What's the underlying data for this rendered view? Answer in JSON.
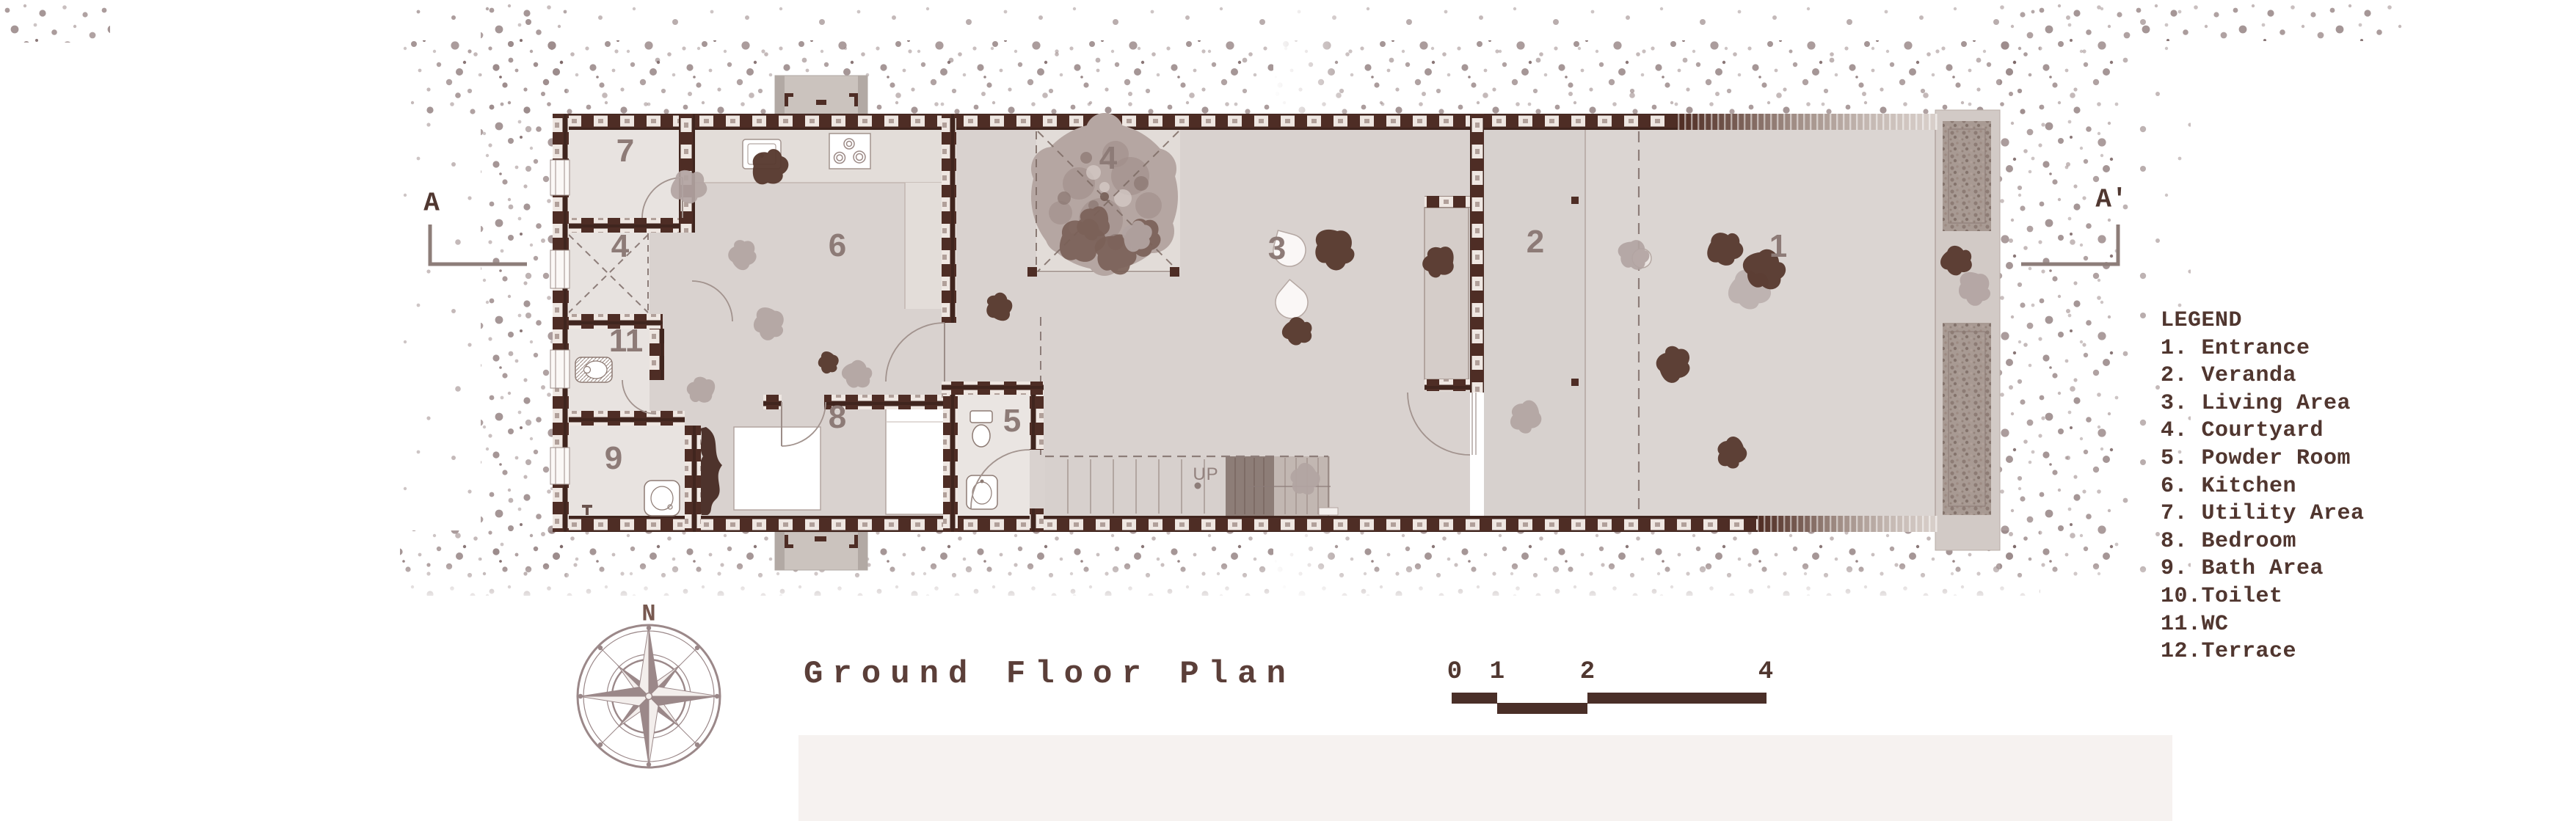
{
  "title": {
    "text": "Ground Floor Plan"
  },
  "compass": {
    "north_label": "N"
  },
  "section_markers": {
    "left": "A",
    "right": "A'"
  },
  "scale_bar": {
    "ticks": [
      "0",
      "1",
      "2",
      "4"
    ]
  },
  "legend": {
    "heading": "LEGEND",
    "items": [
      "1. Entrance",
      "2. Veranda",
      "3. Living Area",
      "4. Courtyard",
      "5. Powder Room",
      "6. Kitchen",
      "7. Utility Area",
      "8. Bedroom",
      "9. Bath Area",
      "10.Toilet",
      "11.WC",
      "12.Terrace"
    ]
  },
  "plan": {
    "stairs_label": "UP",
    "room_labels": [
      {
        "n": "7"
      },
      {
        "n": "4"
      },
      {
        "n": "6"
      },
      {
        "n": "11"
      },
      {
        "n": "9"
      },
      {
        "n": "8"
      },
      {
        "n": "5"
      },
      {
        "n": "4"
      },
      {
        "n": "3"
      },
      {
        "n": "2"
      },
      {
        "n": "1"
      }
    ]
  },
  "colors": {
    "ink": "#503730",
    "wall_brick": "#4e2d25",
    "room_label": "#8d7b77",
    "stipple": "#9c8b8b",
    "paper": "#ffffff"
  }
}
